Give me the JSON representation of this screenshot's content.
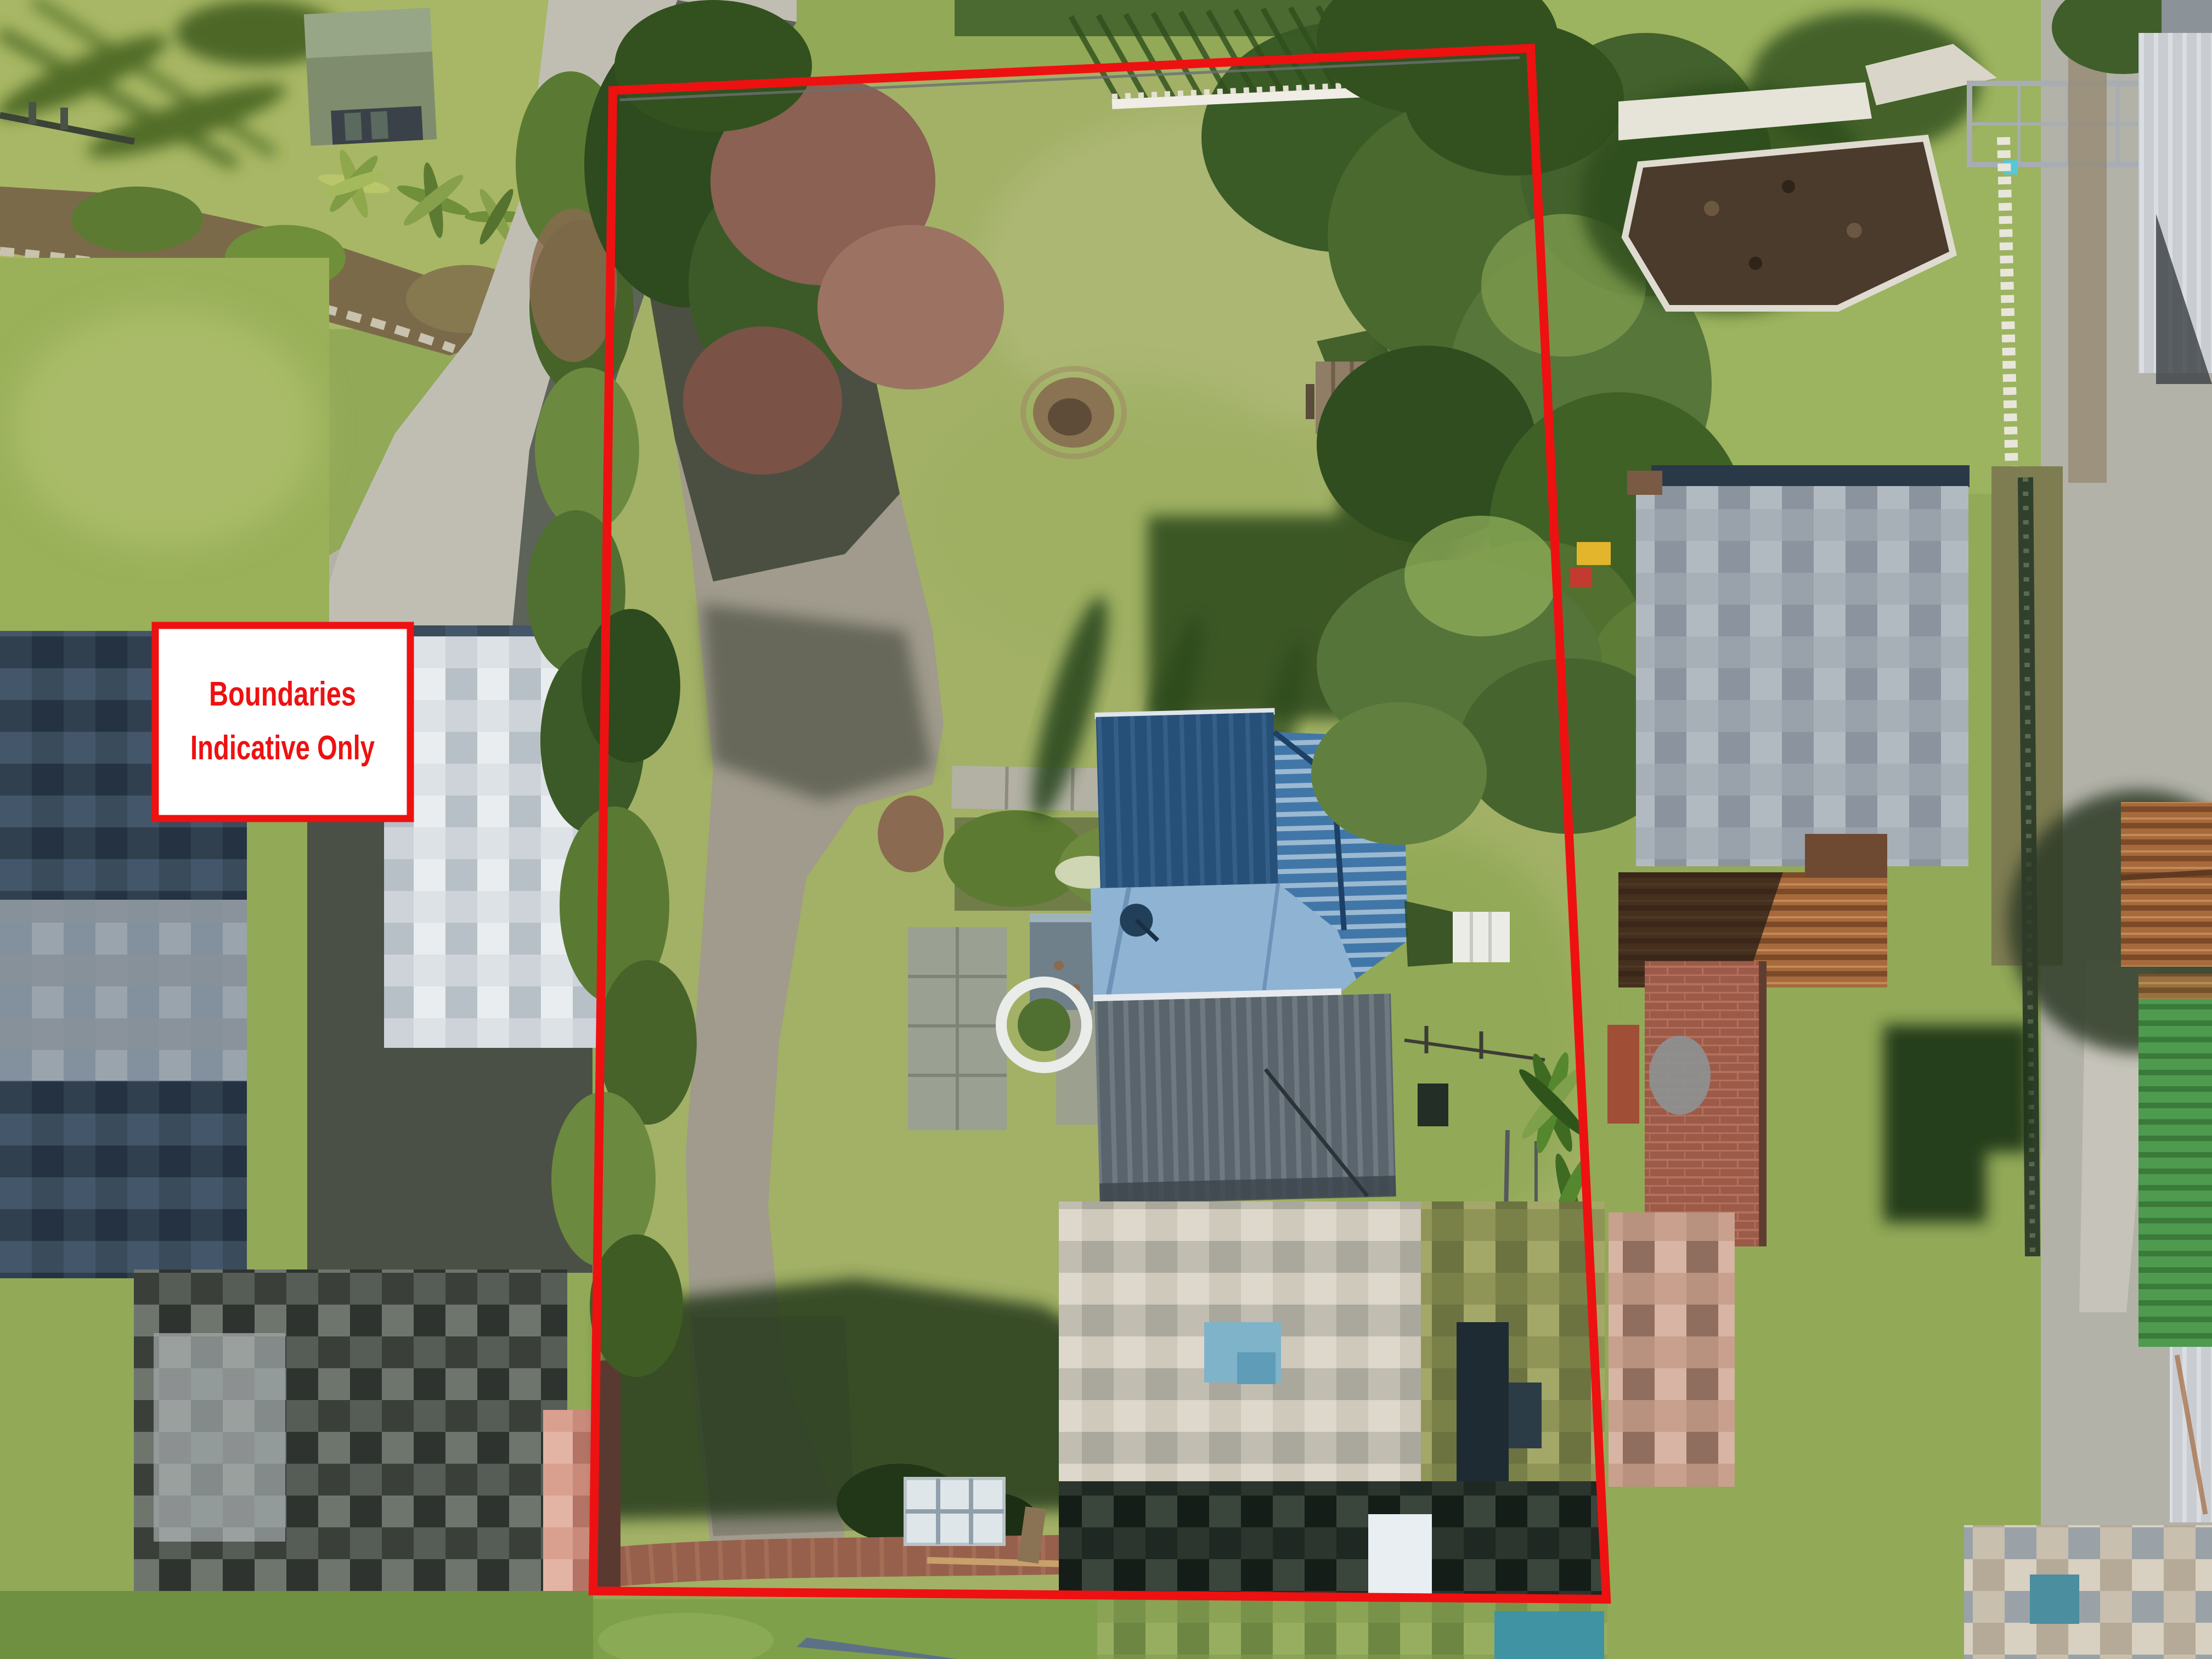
{
  "overlay": {
    "disclaimer_line1": "Boundaries",
    "disclaimer_line2": "Indicative Only"
  },
  "colors": {
    "boundary_red": "#ee1111",
    "label_background": "#ffffff",
    "label_border": "#ee1111",
    "label_text": "#ee1111"
  }
}
